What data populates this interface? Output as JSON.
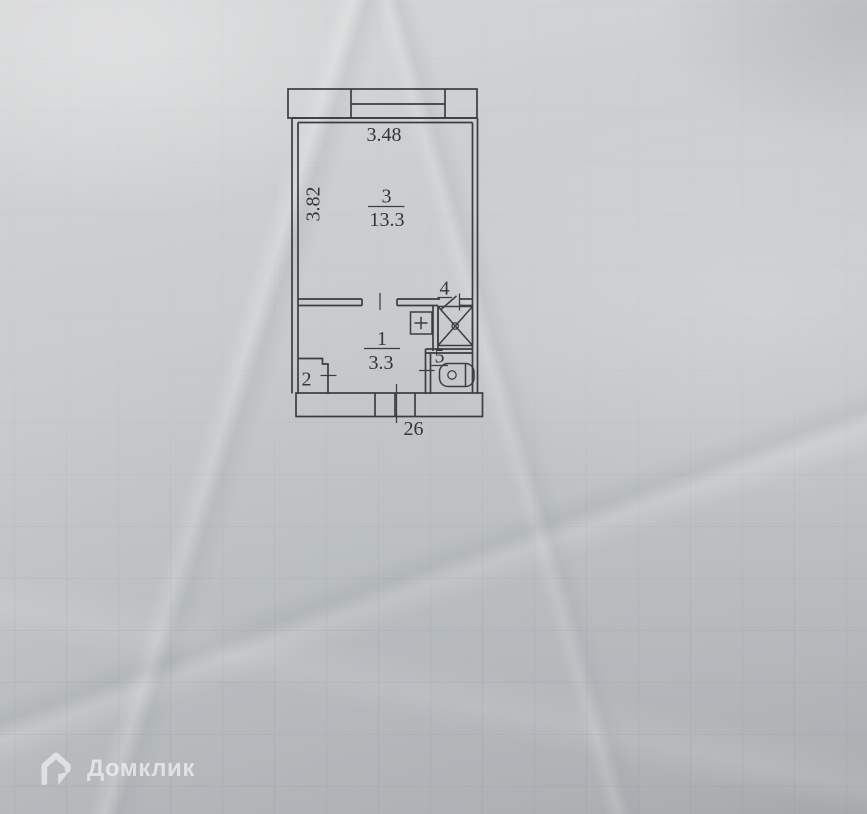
{
  "floorplan": {
    "dimensions": {
      "width_m": "3.48",
      "depth_m": "3.82"
    },
    "rooms": {
      "living": {
        "number": "3",
        "area": "13.3"
      },
      "hall": {
        "number": "1",
        "area": "3.3"
      },
      "closet": {
        "number": "2"
      },
      "shower": {
        "number": "4"
      },
      "wc": {
        "number": "5"
      }
    },
    "entrance": {
      "apartment_number": "26"
    }
  },
  "watermark": {
    "brand": "Домклик",
    "icon": "domclick-house-icon"
  },
  "colors": {
    "paper": "#c8cbcd",
    "ink": "#3b3d40",
    "watermark_tint": "rgba(255,255,255,0.55)"
  }
}
